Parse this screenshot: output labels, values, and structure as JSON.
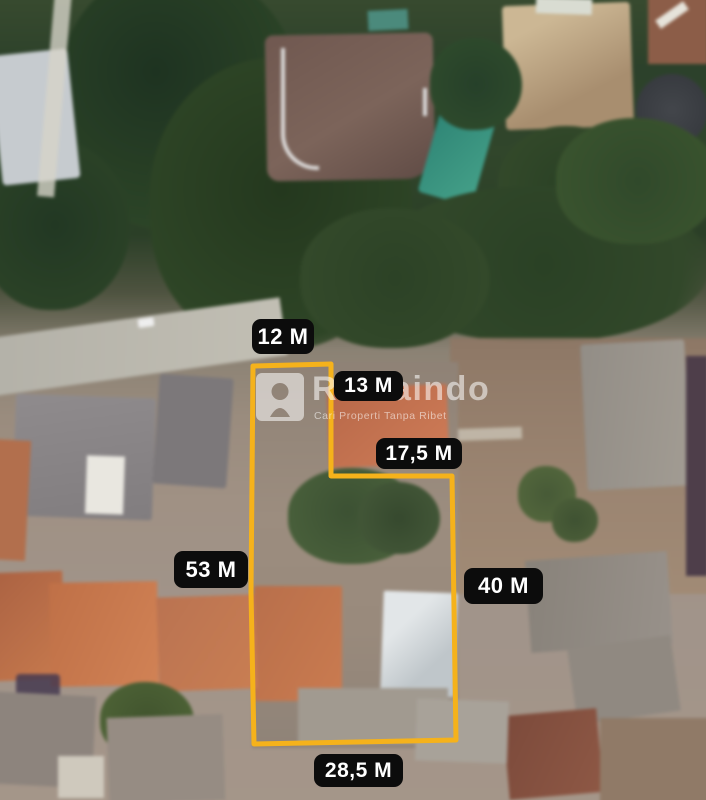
{
  "watermark": {
    "brand": "Rumaindo",
    "tagline": "Cari Properti Tanpa Ribet"
  },
  "measurements": {
    "top_edge": "12 M",
    "notch_vertical": "13 M",
    "notch_horizontal": "17,5 M",
    "left_edge": "53 M",
    "right_edge": "40 M",
    "bottom_edge": "28,5 M"
  },
  "boundary": {
    "svg_points": "253,366 331,364 331,476 452,476 456,740 254,744 251,592",
    "stroke_width": "5"
  },
  "colors": {
    "boundary": "#F5B21B",
    "label_bg": "#0C0C0C",
    "label_text": "#FFFFFF",
    "watermark_text": "#FFFFFF"
  }
}
